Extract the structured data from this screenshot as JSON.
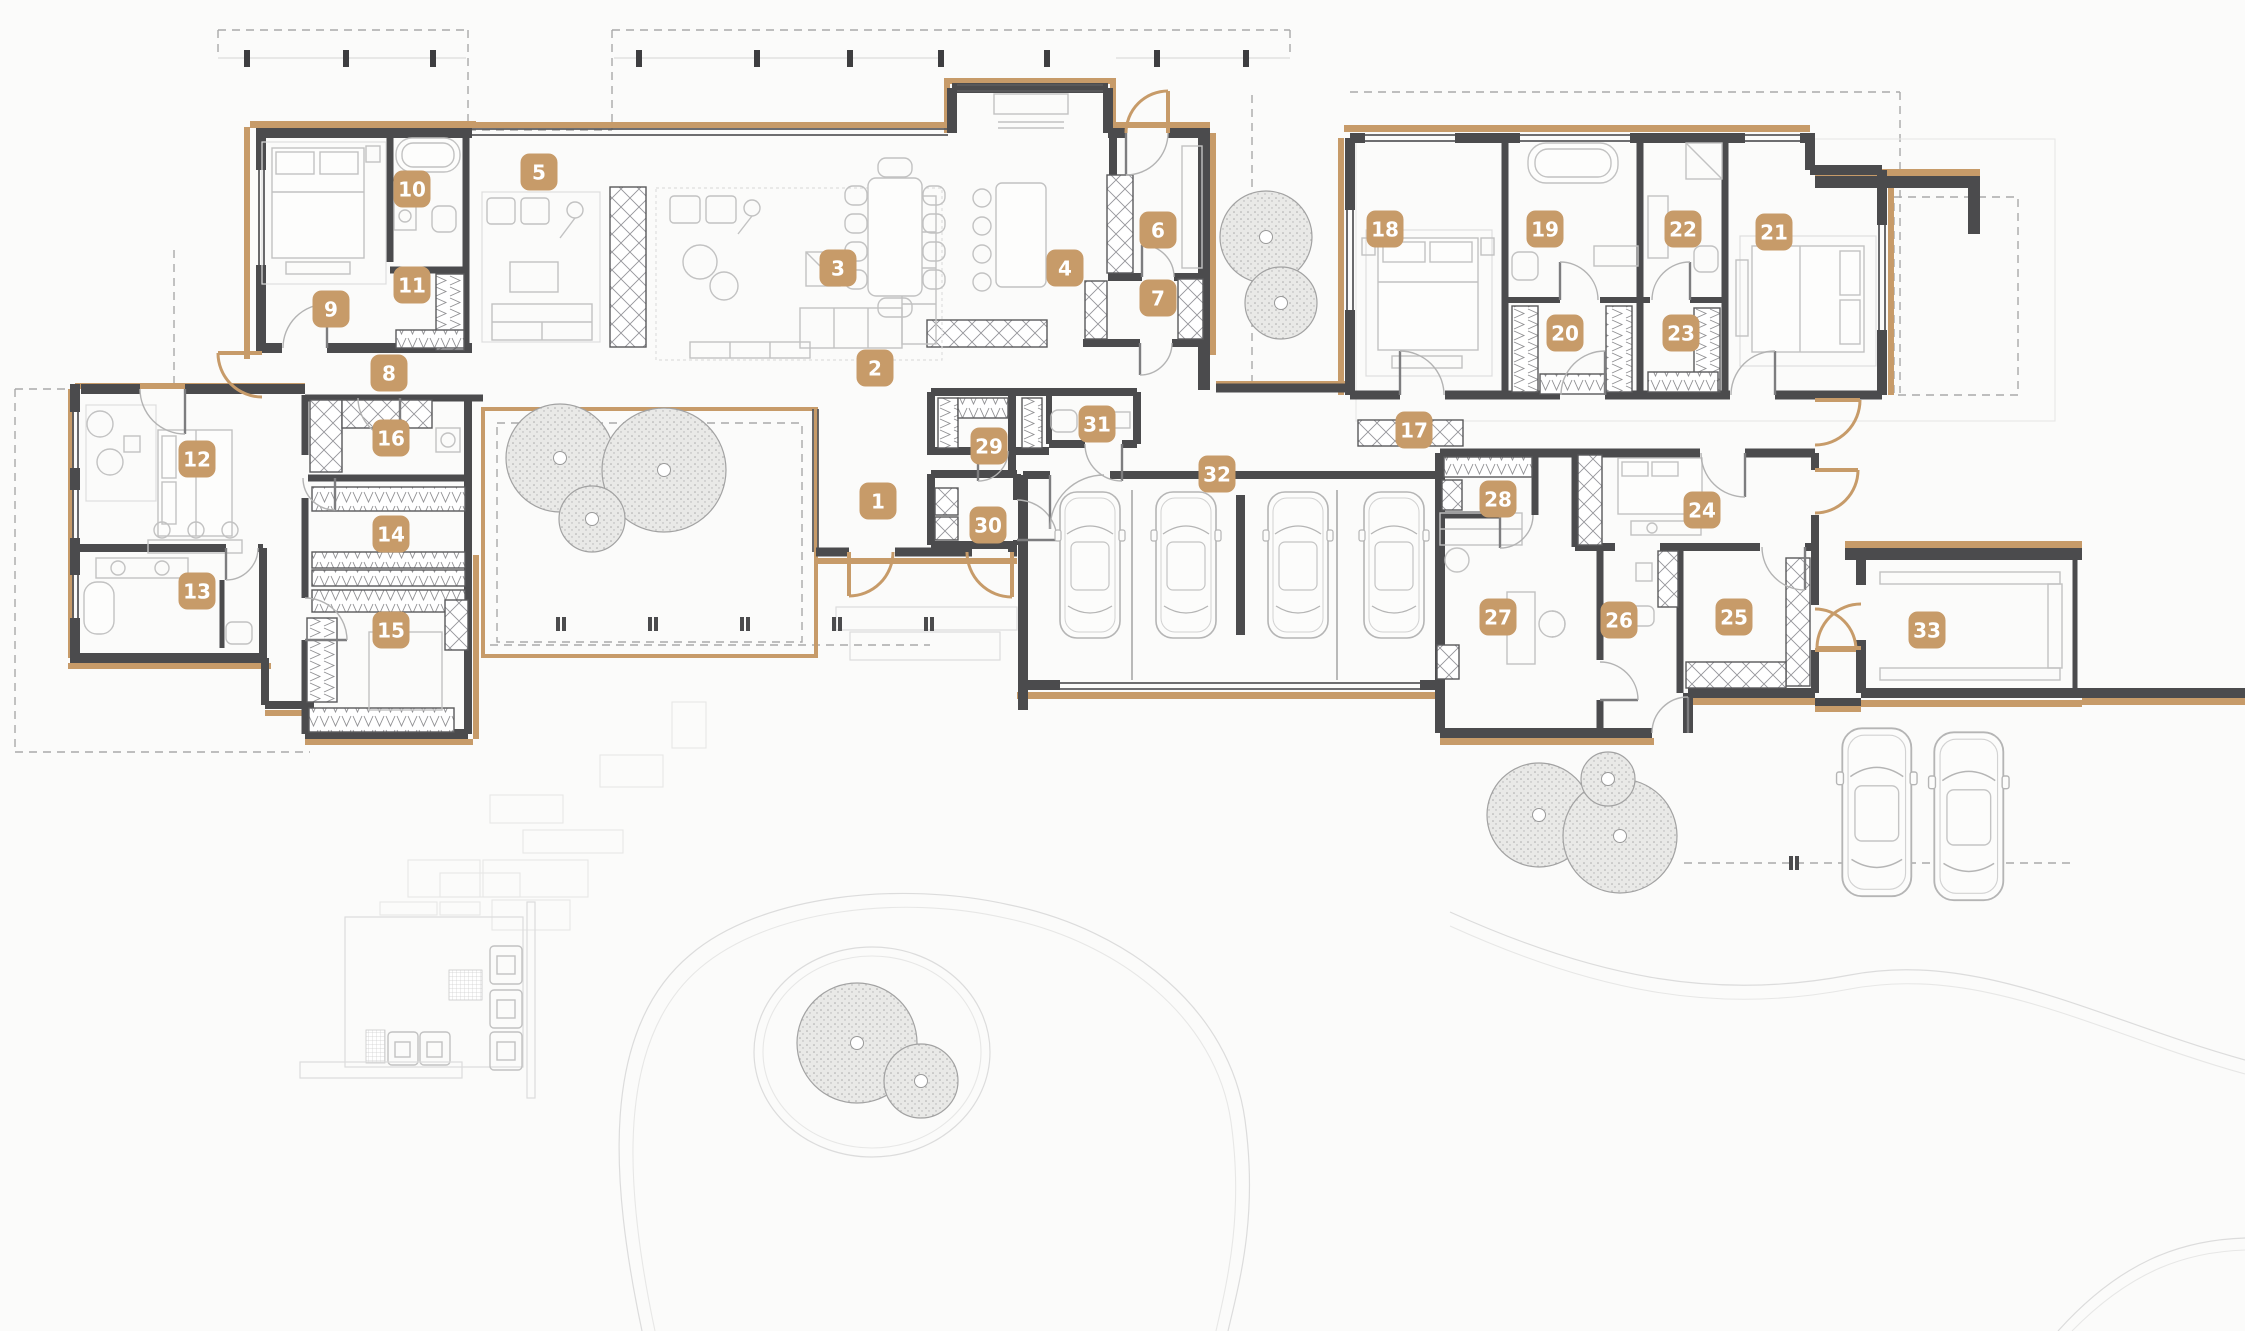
{
  "meta": {
    "type": "architectural-floor-plan",
    "rooms_count": 33
  },
  "colors": {
    "accent": "#C79B69",
    "wall": "#4B4B4D",
    "furniture": "#C2C2C2",
    "tree_fill": "#E7E7E5",
    "tree_edge": "#A2A2A2",
    "background": "#FBFBFA",
    "dashed_line": "#A9A9A9",
    "path_line": "#DADADA"
  },
  "plan": {
    "labels": [
      {
        "n": "1",
        "x": 878,
        "y": 501
      },
      {
        "n": "2",
        "x": 875,
        "y": 368
      },
      {
        "n": "3",
        "x": 838,
        "y": 268
      },
      {
        "n": "4",
        "x": 1065,
        "y": 268
      },
      {
        "n": "5",
        "x": 539,
        "y": 172
      },
      {
        "n": "6",
        "x": 1158,
        "y": 230
      },
      {
        "n": "7",
        "x": 1158,
        "y": 298
      },
      {
        "n": "8",
        "x": 389,
        "y": 373
      },
      {
        "n": "9",
        "x": 331,
        "y": 309
      },
      {
        "n": "10",
        "x": 412,
        "y": 189
      },
      {
        "n": "11",
        "x": 412,
        "y": 285
      },
      {
        "n": "12",
        "x": 197,
        "y": 459
      },
      {
        "n": "13",
        "x": 197,
        "y": 591
      },
      {
        "n": "14",
        "x": 391,
        "y": 534
      },
      {
        "n": "15",
        "x": 391,
        "y": 630
      },
      {
        "n": "16",
        "x": 391,
        "y": 438
      },
      {
        "n": "17",
        "x": 1414,
        "y": 430
      },
      {
        "n": "18",
        "x": 1385,
        "y": 229
      },
      {
        "n": "19",
        "x": 1545,
        "y": 229
      },
      {
        "n": "20",
        "x": 1565,
        "y": 333
      },
      {
        "n": "21",
        "x": 1774,
        "y": 232
      },
      {
        "n": "22",
        "x": 1683,
        "y": 229
      },
      {
        "n": "23",
        "x": 1681,
        "y": 333
      },
      {
        "n": "24",
        "x": 1702,
        "y": 510
      },
      {
        "n": "25",
        "x": 1734,
        "y": 617
      },
      {
        "n": "26",
        "x": 1619,
        "y": 620
      },
      {
        "n": "27",
        "x": 1498,
        "y": 617
      },
      {
        "n": "28",
        "x": 1498,
        "y": 499
      },
      {
        "n": "29",
        "x": 989,
        "y": 446
      },
      {
        "n": "30",
        "x": 988,
        "y": 525
      },
      {
        "n": "31",
        "x": 1097,
        "y": 424
      },
      {
        "n": "32",
        "x": 1217,
        "y": 474
      },
      {
        "n": "33",
        "x": 1927,
        "y": 630
      }
    ],
    "trees": [
      {
        "x": 560,
        "y": 458,
        "r": 54
      },
      {
        "x": 664,
        "y": 470,
        "r": 62
      },
      {
        "x": 592,
        "y": 519,
        "r": 33
      },
      {
        "x": 1266,
        "y": 237,
        "r": 46
      },
      {
        "x": 1281,
        "y": 303,
        "r": 36
      },
      {
        "x": 1539,
        "y": 815,
        "r": 52
      },
      {
        "x": 1620,
        "y": 836,
        "r": 57
      },
      {
        "x": 1608,
        "y": 779,
        "r": 27
      },
      {
        "x": 857,
        "y": 1043,
        "r": 60
      },
      {
        "x": 921,
        "y": 1081,
        "r": 37
      }
    ],
    "cars": [
      {
        "x": 1058,
        "y": 490,
        "s": 1.0
      },
      {
        "x": 1154,
        "y": 490,
        "s": 1.0
      },
      {
        "x": 1266,
        "y": 490,
        "s": 1.0
      },
      {
        "x": 1362,
        "y": 490,
        "s": 1.0
      },
      {
        "x": 1840,
        "y": 726,
        "s": 1.15
      },
      {
        "x": 1932,
        "y": 730,
        "s": 1.15
      }
    ]
  }
}
